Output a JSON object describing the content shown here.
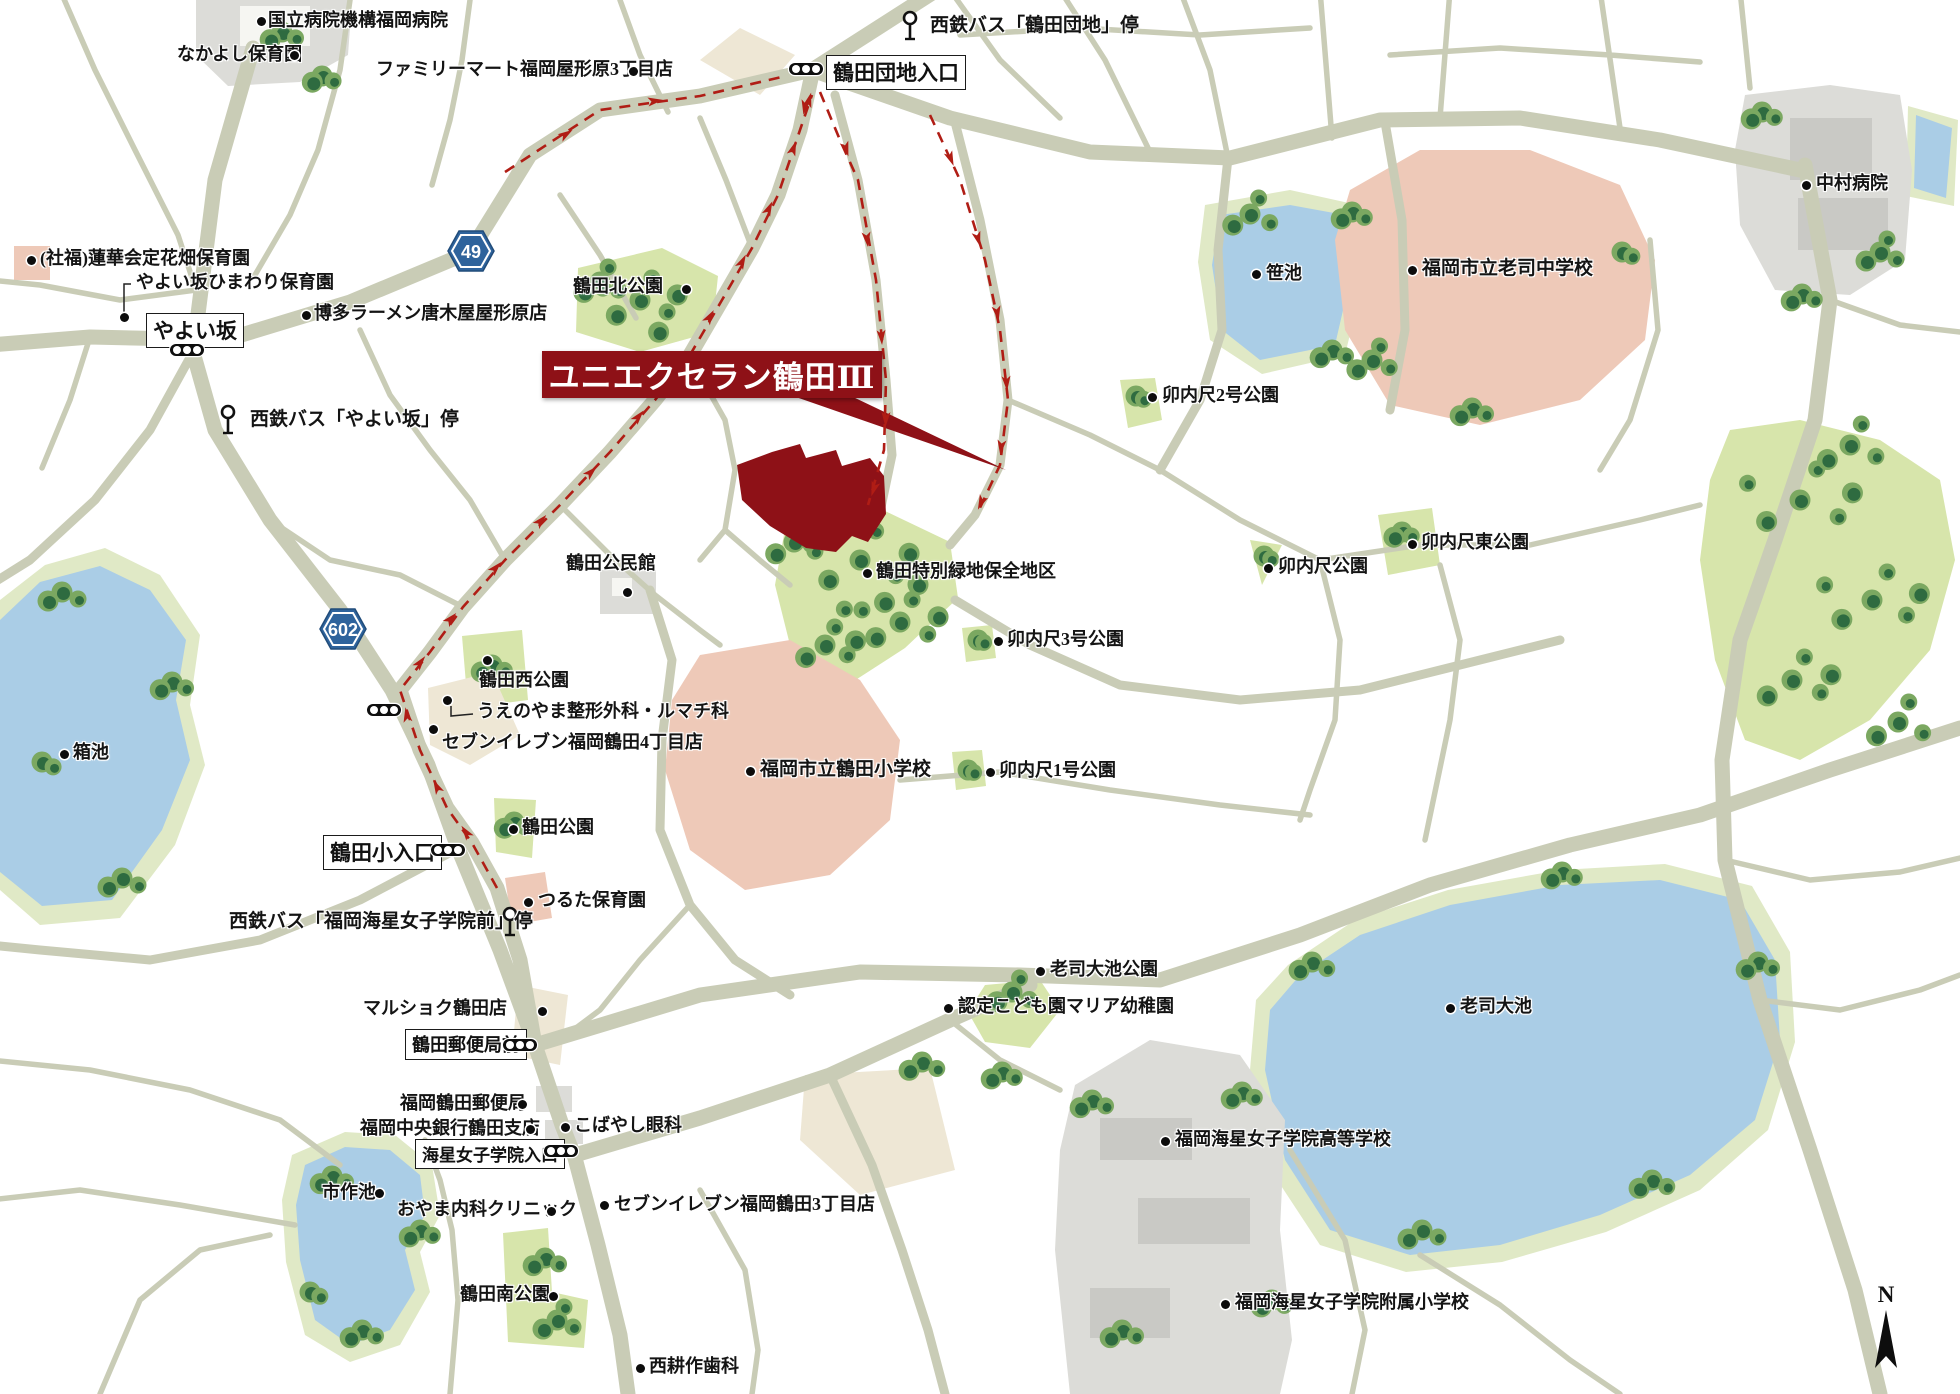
{
  "map": {
    "title": {
      "text": "ユニエクセラン鶴田Ⅲ"
    },
    "north": {
      "text": "N"
    },
    "colors": {
      "road": "#c9ccb6",
      "water": "#aacde6",
      "waterEdge": "#e0e9c6",
      "park": "#d7e5ab",
      "treeDark": "#2e6b40",
      "treeLight": "#7ba861",
      "school": "#eec9b8",
      "gray": "#dcdcd8",
      "grayDark": "#c9c9c5",
      "beige": "#eee7d5",
      "site": "#8e1117",
      "route": "#b01d15",
      "shield": "#2e639c",
      "text": "#141414"
    },
    "route_shields": [
      {
        "num": "49",
        "x": 447,
        "y": 230
      },
      {
        "num": "602",
        "x": 319,
        "y": 608
      }
    ],
    "boxed_labels": [
      {
        "t": "鶴田団地入口",
        "x": 826,
        "y": 55,
        "fs": 21
      },
      {
        "t": "やよい坂",
        "x": 146,
        "y": 313,
        "fs": 21
      },
      {
        "t": "鶴田小入口",
        "x": 323,
        "y": 835,
        "fs": 21
      },
      {
        "t": "鶴田郵便局前",
        "x": 405,
        "y": 1029,
        "fs": 18
      },
      {
        "t": "海星女子学院入口",
        "x": 415,
        "y": 1139,
        "fs": 17
      }
    ],
    "bus_stops": [
      {
        "label": "西鉄バス「鶴田団地」停",
        "gx": 910,
        "gy": 10,
        "tx": 930,
        "ty": 16
      },
      {
        "label": "西鉄バス「やよい坂」停",
        "gx": 228,
        "gy": 404,
        "tx": 250,
        "ty": 410
      },
      {
        "label": "西鉄バス「福岡海星女子学院前」停",
        "gx": 510,
        "gy": 906,
        "tx": 229,
        "ty": 912
      }
    ],
    "signals": [
      [
        810,
        70
      ],
      [
        191,
        351
      ],
      [
        388,
        711
      ],
      [
        452,
        851
      ],
      [
        524,
        1046
      ],
      [
        565,
        1152
      ]
    ],
    "labels": [
      {
        "t": "国立病院機構福岡病院",
        "x": 268,
        "y": 11,
        "dot": [
          261,
          21
        ]
      },
      {
        "t": "なかよし保育園",
        "x": 177,
        "y": 45,
        "dot": [
          294,
          55
        ]
      },
      {
        "t": "ファミリーマート福岡屋形原3丁目店",
        "x": 376,
        "y": 60,
        "dot": [
          633,
          71
        ]
      },
      {
        "t": "博多ラーメン唐木屋屋形原店",
        "x": 314,
        "y": 304,
        "dot": [
          306,
          315
        ]
      },
      {
        "t": "(社福)蓮華会定花畑保育園",
        "x": 40,
        "y": 249,
        "dot": [
          31,
          260
        ]
      },
      {
        "t": "やよい坂ひまわり保育園",
        "x": 136,
        "y": 273,
        "dot": [
          124,
          317
        ],
        "leader": [
          [
            131,
            284
          ],
          [
            124,
            284
          ],
          [
            124,
            312
          ]
        ]
      },
      {
        "t": "鶴田北公園",
        "x": 573,
        "y": 277,
        "dot": [
          686,
          289
        ]
      },
      {
        "t": "笹池",
        "x": 1266,
        "y": 264,
        "dot": [
          1256,
          274
        ]
      },
      {
        "t": "福岡市立老司中学校",
        "x": 1422,
        "y": 259,
        "dot": [
          1412,
          270
        ],
        "b": 1
      },
      {
        "t": "中村病院",
        "x": 1816,
        "y": 174,
        "dot": [
          1806,
          185
        ]
      },
      {
        "t": "卯内尺2号公園",
        "x": 1162,
        "y": 386,
        "dot": [
          1152,
          397
        ]
      },
      {
        "t": "卯内尺東公園",
        "x": 1421,
        "y": 533,
        "dot": [
          1412,
          544
        ]
      },
      {
        "t": "卯内尺公園",
        "x": 1278,
        "y": 557,
        "dot": [
          1268,
          568
        ]
      },
      {
        "t": "卯内尺3号公園",
        "x": 1007,
        "y": 630,
        "dot": [
          998,
          641
        ]
      },
      {
        "t": "鶴田公民館",
        "x": 566,
        "y": 554,
        "dot": [
          627,
          592
        ]
      },
      {
        "t": "鶴田特別緑地保全地区",
        "x": 876,
        "y": 562,
        "dot": [
          867,
          573
        ]
      },
      {
        "t": "鶴田西公園",
        "x": 479,
        "y": 671,
        "dot": [
          487,
          660
        ]
      },
      {
        "t": "うえのやま整形外科・ルマチ科",
        "x": 477,
        "y": 702,
        "dot": [
          447,
          700
        ],
        "leader": [
          [
            451,
            706
          ],
          [
            451,
            716
          ],
          [
            473,
            714
          ]
        ]
      },
      {
        "t": "セブンイレブン福岡鶴田4丁目店",
        "x": 442,
        "y": 733,
        "dot": [
          433,
          729
        ]
      },
      {
        "t": "福岡市立鶴田小学校",
        "x": 760,
        "y": 760,
        "dot": [
          750,
          771
        ],
        "b": 1
      },
      {
        "t": "卯内尺1号公園",
        "x": 999,
        "y": 761,
        "dot": [
          990,
          772
        ]
      },
      {
        "t": "箱池",
        "x": 73,
        "y": 743,
        "dot": [
          64,
          754
        ]
      },
      {
        "t": "鶴田公園",
        "x": 522,
        "y": 818,
        "dot": [
          513,
          829
        ]
      },
      {
        "t": "つるた保育園",
        "x": 538,
        "y": 891,
        "dot": [
          528,
          902
        ]
      },
      {
        "t": "マルショク鶴田店",
        "x": 363,
        "y": 999,
        "dot": [
          542,
          1011
        ]
      },
      {
        "t": "福岡鶴田郵便局",
        "x": 400,
        "y": 1094,
        "dot": [
          522,
          1104
        ]
      },
      {
        "t": "福岡中央銀行鶴田支店",
        "x": 360,
        "y": 1119,
        "dot": [
          530,
          1129
        ]
      },
      {
        "t": "こばやし眼科",
        "x": 574,
        "y": 1116,
        "dot": [
          565,
          1127
        ]
      },
      {
        "t": "市作池",
        "x": 322,
        "y": 1183,
        "dot": [
          379,
          1193
        ]
      },
      {
        "t": "おやま内科クリニック",
        "x": 397,
        "y": 1200,
        "dot": [
          551,
          1211
        ]
      },
      {
        "t": "セブンイレブン福岡鶴田3丁目店",
        "x": 614,
        "y": 1195,
        "dot": [
          604,
          1205
        ]
      },
      {
        "t": "老司大池公園",
        "x": 1050,
        "y": 960,
        "dot": [
          1040,
          971
        ]
      },
      {
        "t": "認定こども園マリア幼稚園",
        "x": 958,
        "y": 997,
        "dot": [
          948,
          1008
        ]
      },
      {
        "t": "老司大池",
        "x": 1460,
        "y": 997,
        "dot": [
          1450,
          1008
        ]
      },
      {
        "t": "福岡海星女子学院高等学校",
        "x": 1175,
        "y": 1130,
        "dot": [
          1165,
          1141
        ]
      },
      {
        "t": "福岡海星女子学院附属小学校",
        "x": 1235,
        "y": 1293,
        "dot": [
          1225,
          1304
        ]
      },
      {
        "t": "鶴田南公園",
        "x": 460,
        "y": 1285,
        "dot": [
          553,
          1296
        ]
      },
      {
        "t": "西耕作歯科",
        "x": 649,
        "y": 1357,
        "dot": [
          640,
          1368
        ]
      }
    ],
    "route": {
      "paths": [
        "M505,172 L600,110 L700,96 L786,76",
        "M497,888 L472,843 L447,808 L420,750 L400,690 L430,652 L463,607 L505,560 L560,505 L610,452 L655,400 L690,355 L722,300 L752,248 L778,195 L800,130 L812,95",
        "M820,92 L840,140 L858,180 L876,280 L886,380 L884,450 L868,505",
        "M930,115 L960,180 L985,260 L1000,330 L1008,400 L1000,465 L978,512"
      ],
      "arrows": [
        [
          560,
          138,
          -33
        ],
        [
          648,
          102,
          -8
        ],
        [
          470,
          838,
          -125
        ],
        [
          440,
          793,
          -117
        ],
        [
          408,
          722,
          -100
        ],
        [
          416,
          668,
          -52
        ],
        [
          446,
          624,
          -47
        ],
        [
          491,
          573,
          -47
        ],
        [
          536,
          526,
          -47
        ],
        [
          586,
          477,
          -44
        ],
        [
          634,
          422,
          -50
        ],
        [
          676,
          370,
          -55
        ],
        [
          706,
          323,
          -59
        ],
        [
          739,
          268,
          -63
        ],
        [
          766,
          215,
          -65
        ],
        [
          791,
          155,
          -70
        ],
        [
          807,
          107,
          -74
        ],
        [
          806,
          100,
          100
        ],
        [
          844,
          142,
          73
        ],
        [
          866,
          232,
          83
        ],
        [
          881,
          330,
          86
        ],
        [
          886,
          412,
          92
        ],
        [
          876,
          482,
          108
        ],
        [
          948,
          152,
          68
        ],
        [
          976,
          232,
          74
        ],
        [
          996,
          306,
          80
        ],
        [
          1006,
          376,
          86
        ],
        [
          1002,
          440,
          97
        ],
        [
          984,
          496,
          114
        ]
      ]
    }
  }
}
